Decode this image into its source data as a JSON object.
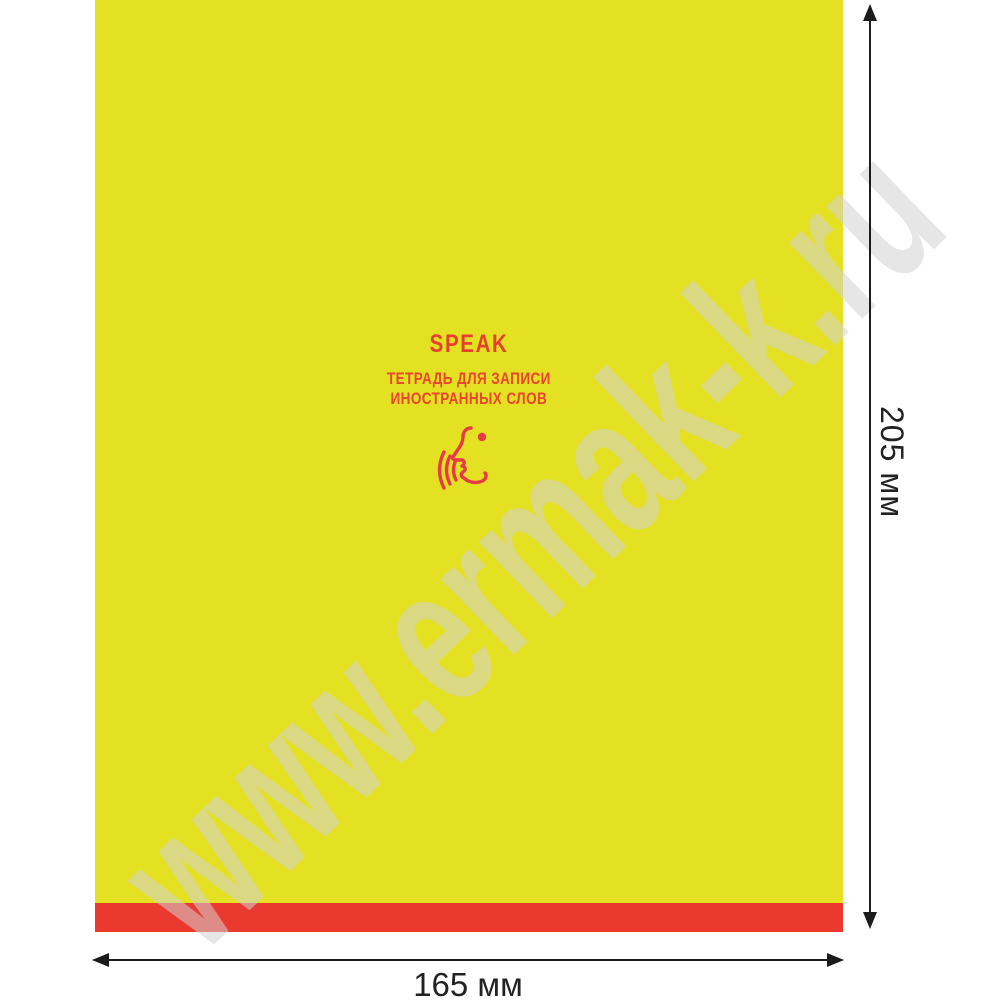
{
  "product_image": {
    "watermark": "www.ermak-k.ru",
    "cover": {
      "title": "SPEAK",
      "subtitle_line1": "ТЕТРАДЬ ДЛЯ ЗАПИСИ",
      "subtitle_line2": "ИНОСТРАННЫХ СЛОВ",
      "icon": "speaking-face-icon"
    },
    "dimensions": {
      "height": "205 мм",
      "width": "165 мм"
    },
    "colors": {
      "cover_yellow": "#e4e122",
      "stripe_red": "#ea392f",
      "text_red": "#e8402f",
      "icon_red": "#e73b44",
      "arrow_black": "#1b1b1b",
      "watermark_gray": "#d2d2d2"
    }
  }
}
